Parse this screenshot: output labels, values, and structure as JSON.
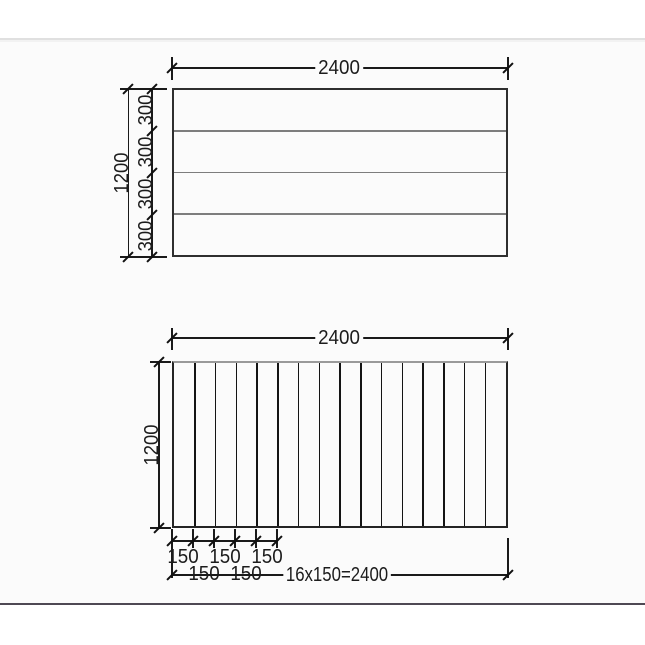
{
  "page": {
    "type": "technical-drawing",
    "background": "#ffffff",
    "top_divider_color": "#e0e0e0",
    "footer_line_color": "#4e4954",
    "line_color": "#1a1a1a",
    "text_color": "#1c1c1c"
  },
  "top_drawing": {
    "width_label": "2400",
    "height_label": "1200",
    "rows": 4,
    "row_height_labels": [
      "300",
      "300",
      "300",
      "300"
    ]
  },
  "bottom_drawing": {
    "width_label": "2400",
    "height_label": "1200",
    "columns": 16,
    "spacing_labels_upper": [
      "150",
      "150",
      "150"
    ],
    "spacing_labels_lower": [
      "150",
      "150"
    ],
    "total_label": "16x150=2400"
  }
}
